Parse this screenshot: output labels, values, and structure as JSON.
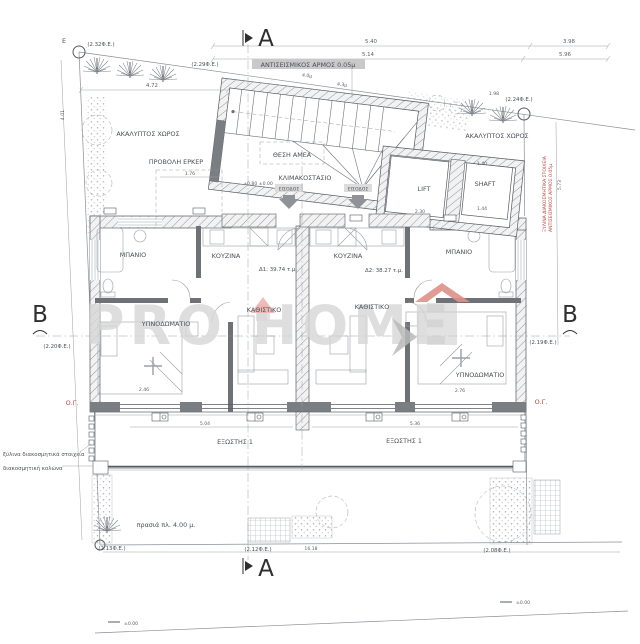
{
  "plan": {
    "sections": {
      "a": "A",
      "b": "B"
    },
    "site": {
      "corner_letter": "E",
      "open_space": "ΑΚΑΛΥΠΤΟΣ ΧΩΡΟΣ",
      "green_strip": "πρασιά πλ. 4.00 μ.",
      "building_line": "Ο.Γ.",
      "refs": {
        "tl": "(2.32Φ.Ε.)",
        "t2": "(2.29Φ.Ε.)",
        "tr": "(2.24Φ.Ε.)",
        "ml": "(2.20Φ.Ε.)",
        "mr": "(2.19Φ.Ε.)",
        "bl": "(2.13Φ.Ε.)",
        "bc": "(2.12Φ.Ε.)",
        "br": "(2.08Φ.Ε.)"
      },
      "notes": {
        "wood_elements": "ξύλινα διακοσμητικά στοιχεία",
        "decorative_column": "διακοσμητική κολώνα",
        "side_note_1": "ΞΥΛΙΝΑ ΔΙΑΚΟΣΜΗΤΙΚΑ ΣΤΟΙΧΕΙΑ",
        "side_note_2": "ΑΝΤΙΣΕΙΣΜΙΚΟΣ ΑΡΜΟΣ 0.05μ"
      },
      "ground_mark_left": "±0.00",
      "ground_mark_right": "±0.00"
    },
    "building": {
      "seismic_joint": "ΑΝΤΙΣΕΙΣΜΙΚΟΣ ΑΡΜΟΣ 0.05μ",
      "bay_projection": "ΠΡΟΒΟΛΗ ΕΡΚΕΡ",
      "stairwell": "ΚΛΙΜΑΚΟΣΤΑΣΙΟ",
      "ada_spot": "ΘΕΣΗ ΑΜΕΑ",
      "stair_level": "+0.80 ±0.00",
      "entrance": "ΕΙΣΟΔΟΣ",
      "lift": "LIFT",
      "shaft": "SHAFT"
    },
    "apartments": {
      "d1": {
        "area": "Δ1: 39.74 τ.μ.",
        "bathroom": "ΜΠΑΝΙΟ",
        "kitchen": "ΚΟΥΖΙΝΑ",
        "living": "ΚΑΘΙΣΤΙΚΟ",
        "bedroom": "ΥΠΝΟΔΩΜΑΤΙΟ",
        "balcony": "ΕΞΩΣΤΗΣ 1"
      },
      "d2": {
        "area": "Δ2: 38.27 τ.μ.",
        "bathroom": "ΜΠΑΝΙΟ",
        "kitchen": "ΚΟΥΖΙΝΑ",
        "living": "ΚΑΘΙΣΤΙΚΟ",
        "bedroom": "ΥΠΝΟΔΩΜΑΤΙΟ",
        "balcony": "ΕΞΩΣΤΗΣ 1"
      }
    },
    "dims": {
      "top_a": "5.40",
      "top_b": "5.14",
      "top_c": "3.98",
      "top_d": "5.96",
      "left_top": "4.72",
      "left_vert": "4.01",
      "right_vert": "5.73",
      "roof_a": "4.0μ",
      "roof_b": "4.3μ",
      "bay": "1.76",
      "n198": "1.98",
      "lift_w": "2.30",
      "shaft_t": "1.40",
      "shaft_b": "1.44",
      "bed_l": "2.46",
      "bed_r": "2.76",
      "balc_l": "5.04",
      "balc_r": "5.36",
      "bottom": "16.18"
    },
    "watermark": {
      "pro": "PRO",
      "home": "HOME"
    },
    "colors": {
      "accent_red": "#b8463c",
      "watermark_gray": "#d6d6d6",
      "watermark_red": "#dd9088"
    }
  }
}
